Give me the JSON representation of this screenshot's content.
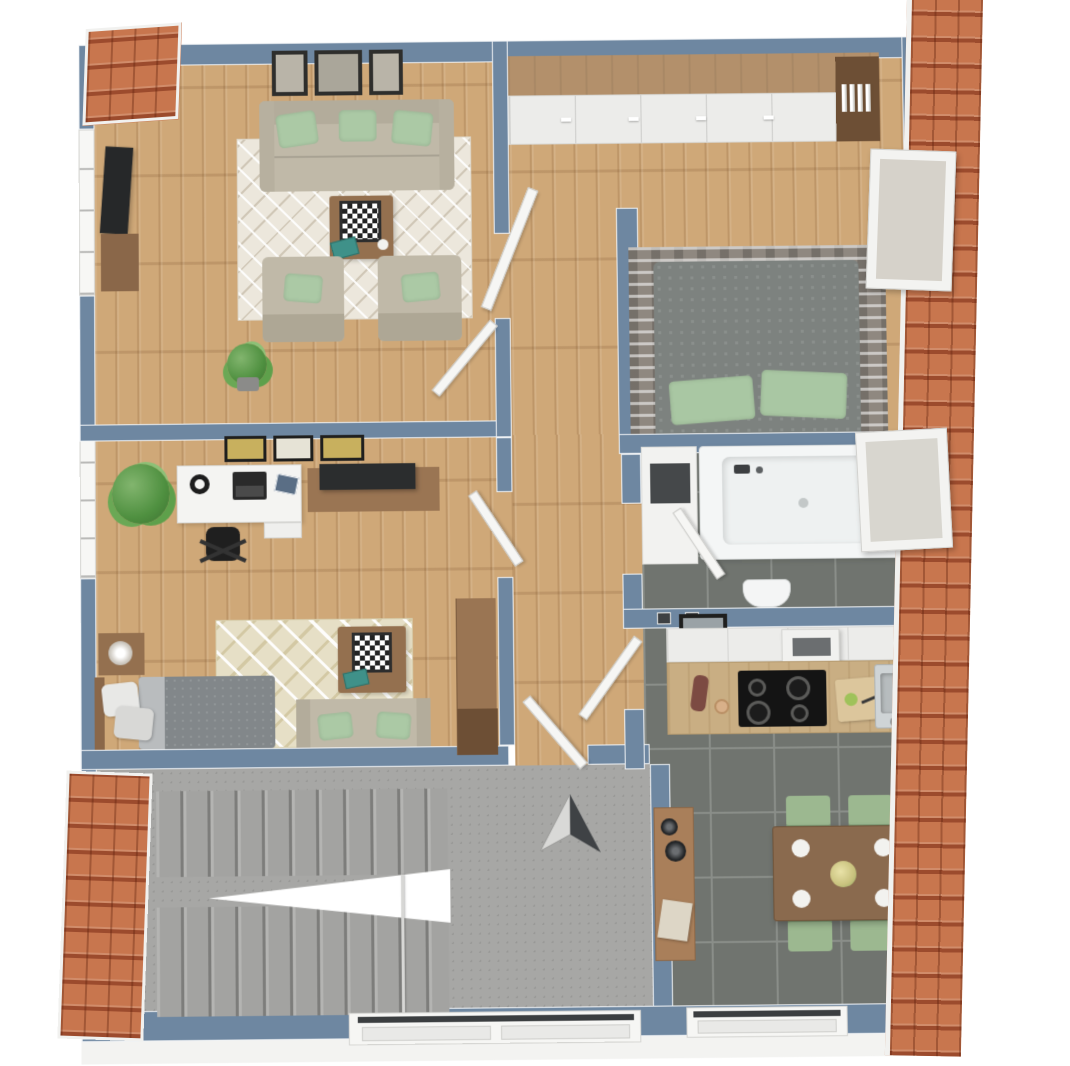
{
  "watermark": {
    "text": "McGrundriss"
  },
  "palette": {
    "background": "#ffffff",
    "wall_top": "#6e87a1",
    "wall_face": "#f2f2f1",
    "roof_tile": "#c8764e",
    "roof_shadow": "#a04f2e",
    "wood_floor": "#cfa878",
    "tile_floor": "#70746f",
    "concrete": "#a7a7a5",
    "sofa_beige": "#c0b9a8",
    "pillow_green": "#abc9a5",
    "bed_gray": "#7d827f",
    "dining_chair_green": "#9cb890",
    "furniture_wood": "#94704f",
    "rug_cream": "#ece7dc"
  },
  "plan": {
    "type": "3d-top-down-floor-plan",
    "compass": {
      "marker": "north-arrow",
      "location": "entrance-landing"
    },
    "rooms": [
      {
        "id": "living-room",
        "floor": "wood",
        "furniture": [
          "three-seat-sofa",
          "green-pillows",
          "three-wall-pictures",
          "lattice-rug",
          "coffee-table",
          "chessboard",
          "teal-book",
          "armchair",
          "armchair",
          "tv-screen",
          "tv-lowboard",
          "potted-plant",
          "open-door"
        ]
      },
      {
        "id": "bedroom",
        "floor": "wood",
        "furniture": [
          "long-wardrobe",
          "book-shelf",
          "double-bed",
          "green-pillows",
          "striped-rug",
          "roof-window",
          "open-door"
        ]
      },
      {
        "id": "office-bedroom",
        "floor": "wood",
        "furniture": [
          "three-wall-pictures",
          "desk",
          "laptop",
          "office-chair",
          "potted-plant",
          "tv-lowboard",
          "single-bed",
          "nightstand",
          "lamp",
          "patterned-rug",
          "loveseat",
          "side-table",
          "chessboard",
          "wardrobe",
          "open-door"
        ]
      },
      {
        "id": "bathroom",
        "floor": "dark-tile",
        "furniture": [
          "bathtub",
          "storage-niche",
          "toilet",
          "roof-window",
          "open-door"
        ]
      },
      {
        "id": "kitchen",
        "floor": "dark-tile",
        "furniture": [
          "upper-cabinets",
          "range-hood",
          "countertop",
          "cooktop",
          "cutting-board",
          "knife",
          "sink",
          "wall-picture",
          "open-door"
        ]
      },
      {
        "id": "dining-area",
        "floor": "dark-tile",
        "furniture": [
          "dining-table",
          "four-plates",
          "flower-centerpiece",
          "green-chair",
          "green-chair",
          "green-chair",
          "green-chair",
          "sideboard",
          "black-vases",
          "window"
        ]
      },
      {
        "id": "hallway",
        "floor": "wood",
        "furniture": []
      },
      {
        "id": "staircase",
        "floor": "concrete",
        "furniture": [
          "switchback-stairs",
          "handrail",
          "north-arrow",
          "window"
        ]
      }
    ],
    "roof_sections": [
      "top-left",
      "bottom-left",
      "right-full-height"
    ]
  }
}
